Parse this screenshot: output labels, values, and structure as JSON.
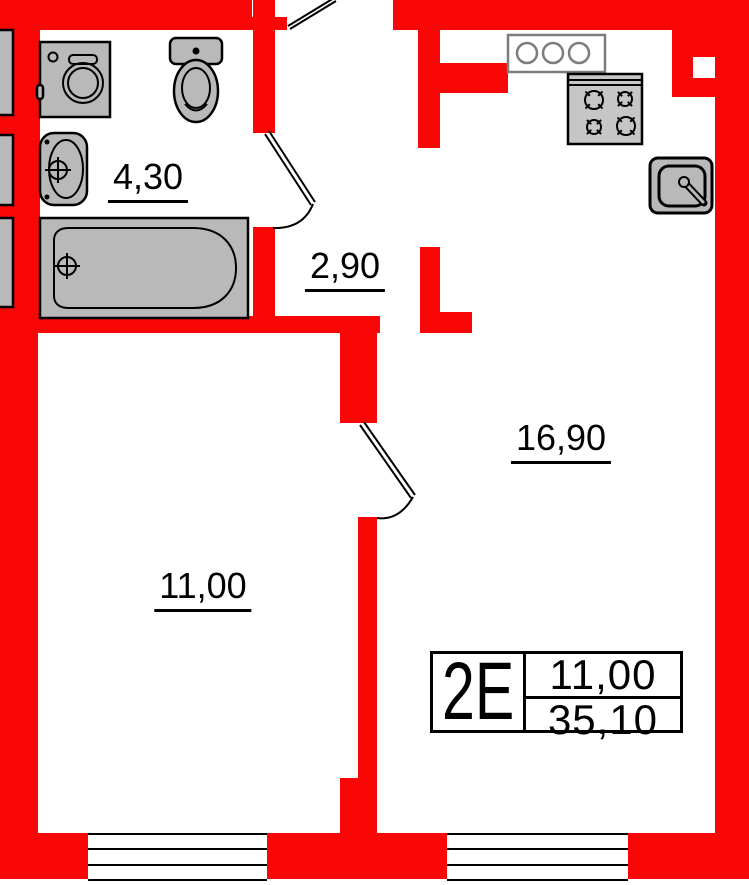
{
  "title": "Apartment floor plan 2E",
  "colors": {
    "wall": "#f90606",
    "fixture": "#b9b9b9",
    "stove_fill": "#c6c6c6",
    "line": "#000000",
    "vent_border": "#7d7d7d",
    "background": "#ffffff"
  },
  "rooms": {
    "bathroom": {
      "area_label": "4,30"
    },
    "hallway": {
      "area_label": "2,90"
    },
    "kitchen_living": {
      "area_label": "16,90"
    },
    "room": {
      "area_label": "11,00"
    }
  },
  "stamp": {
    "unit_type": "2E",
    "living_area": "11,00",
    "total_area": "35,10"
  },
  "fixtures": [
    "washing-machine",
    "toilet",
    "washbasin",
    "bathtub",
    "vent-block",
    "stove",
    "kitchen-sink"
  ],
  "doors": [
    "entrance-door",
    "bathroom-door",
    "room-kitchen-door"
  ],
  "windows_count": 2
}
